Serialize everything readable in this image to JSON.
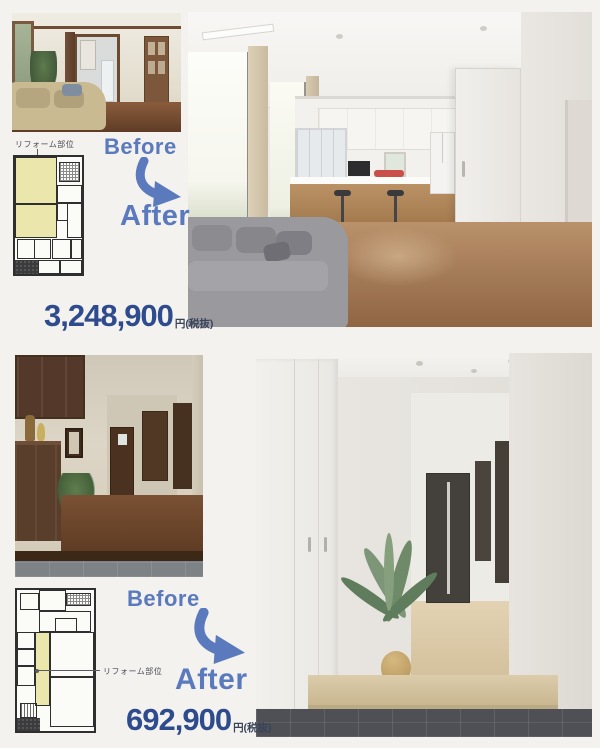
{
  "page": {
    "background": "#f3f2ef"
  },
  "colors": {
    "accent_blue": "#5b7abd",
    "price_navy": "#2d4b8d",
    "plan_highlight_yellow": "#ebe6ac",
    "plan_line": "#2f2f2f"
  },
  "top": {
    "plan_label": "リフォーム部位",
    "before_label": "Before",
    "after_label": "After",
    "price_amount": "3,248,900",
    "price_unit": "円(税抜)"
  },
  "bottom": {
    "plan_label": "リフォーム部位",
    "before_label": "Before",
    "after_label": "After",
    "price_amount": "692,900",
    "price_unit": "円(税抜)"
  }
}
